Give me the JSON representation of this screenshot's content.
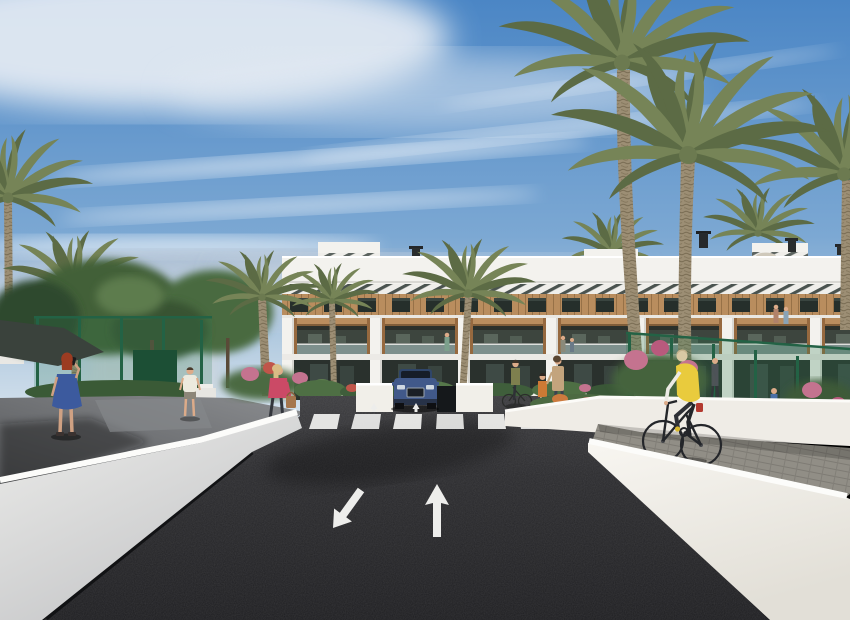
{
  "meta": {
    "type": "architectural-3d-rendering",
    "description": "Photorealistic exterior render of a modern white three-storey apartment complex with wood-clad balconies, fronted by tall date palms, a dark asphalt access road with zebra crosswalk and painted lane arrows, white retaining walls, a cyclist on a paved side path, and several pedestrians",
    "visible_text": []
  },
  "palette": {
    "sky_top": "#4b86c5",
    "sky_mid": "#7ca8d3",
    "sky_horizon": "#dae5ef",
    "cloud": "#edf1f6",
    "road": "#28282b",
    "road_far": "#3b3b3e",
    "marking_white": "#ededeb",
    "wall_sunlit": "#f6f4ee",
    "wall_shaded": "#d9dadb",
    "wall_top": "#fcfcfa",
    "path_gray": "#918e86",
    "walkway_gray": "#7d7f82",
    "building_white": "#f3f2ee",
    "building_shadow": "#d9d8d3",
    "wood": "#b98d5e",
    "wood_dark": "#96693f",
    "window_dark": "#262f2b",
    "balcony_interior": "#3d453e",
    "glass": "#71827a",
    "louver_stripe": "#4a534f",
    "palm_green": "#768457",
    "palm_green_dark": "#5c6b45",
    "palm_trunk": "#9c8e74",
    "tree_green": "#436038",
    "tree_green_dark": "#2e4a2e",
    "hedge_green": "#4e6f44",
    "fence_green": "#236245",
    "flower_pink": "#c4738f",
    "flower_red": "#c0554a",
    "flower_orange": "#cc7a3e",
    "car_blue": "#41598a",
    "car_roof": "#2f4569",
    "vest_yellow": "#e9cb3d",
    "skin": "#dcab89",
    "dress_blue": "#3c5a9e",
    "hair_red": "#9c3c22",
    "top_pink": "#cb4a66",
    "shirt_white": "#eceade",
    "bag_brown": "#a5764d"
  },
  "scene": {
    "elements": [
      "sky",
      "cirrus-clouds",
      "apartment-building",
      "roof-structures",
      "louver-band",
      "upper-window-row",
      "wood-band",
      "balcony-row",
      "ground-floor",
      "palm-trees",
      "tree-canopies",
      "chain-link-fences",
      "shade-canopy",
      "left-walkway",
      "woman-blue-dress",
      "man-white-shirt",
      "woman-pink-top",
      "flower-planters",
      "access-road",
      "crosswalk",
      "lane-arrow-forward",
      "lane-arrow-down-left",
      "car-at-garage-ramp",
      "pedestrian-group",
      "bike-path",
      "cyclist",
      "retaining-wall-left",
      "retaining-wall-right",
      "balcony-people"
    ]
  }
}
